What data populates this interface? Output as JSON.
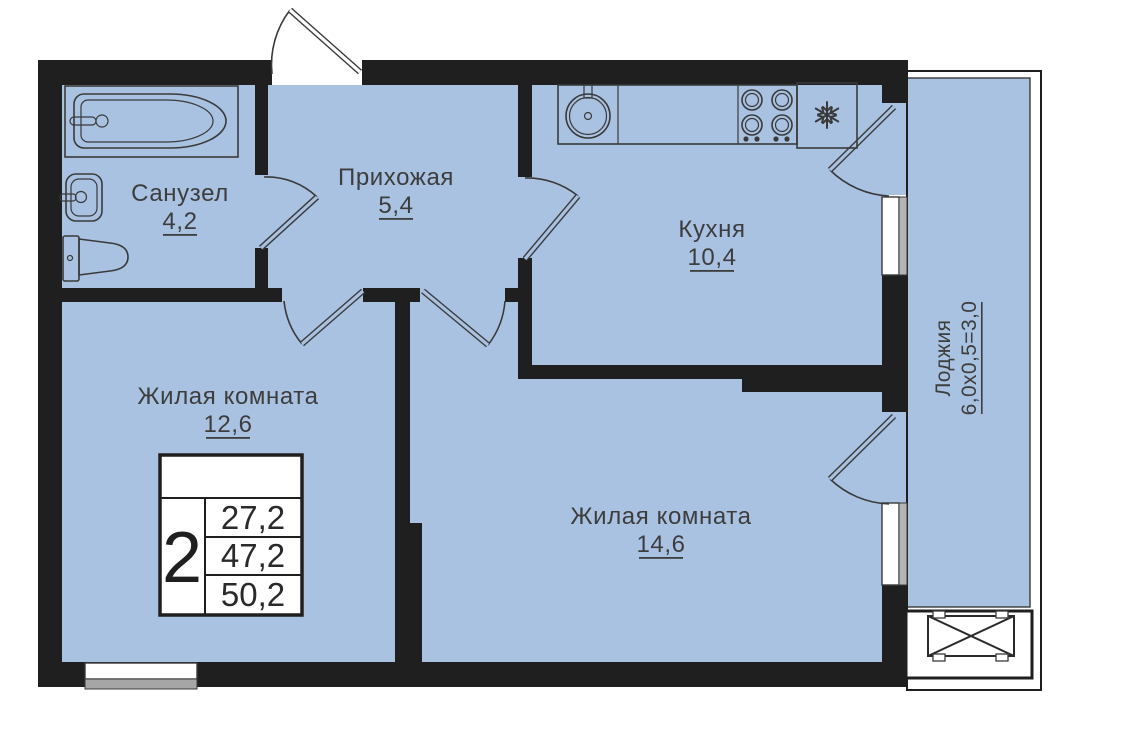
{
  "plan_title": "2-room apartment floor plan",
  "rooms": {
    "bathroom": {
      "name": "Санузел",
      "area": "4,2"
    },
    "hallway": {
      "name": "Прихожая",
      "area": "5,4"
    },
    "kitchen": {
      "name": "Кухня",
      "area": "10,4"
    },
    "living_small": {
      "name": "Жилая комната",
      "area": "12,6"
    },
    "living_large": {
      "name": "Жилая комната",
      "area": "14,6"
    },
    "loggia": {
      "name": "Лоджия",
      "area": "6,0x0,5=3,0"
    }
  },
  "stamp": {
    "rooms_count": "2",
    "values": [
      "27,2",
      "47,2",
      "50,2"
    ]
  },
  "icons": {
    "bathtub-icon": "bathtub outline drawing",
    "bath-sink-icon": "wash basin outline drawing",
    "toilet-icon": "toilet outline drawing",
    "kitchen-sink-icon": "round kitchen sink drawing",
    "stove-icon": "4-burner cooktop drawing",
    "snowflake-icon": "snowflake (refrigerator) glyph",
    "ac-basket-icon": "crossed rectangle (AC basket)"
  },
  "colors": {
    "floor": "#a9c2e2",
    "wall": "#1f1f1f",
    "outline": "#3a3a3a",
    "text": "#3d3d3d",
    "window_sill": "#a6a6a6",
    "background": "#ffffff"
  }
}
